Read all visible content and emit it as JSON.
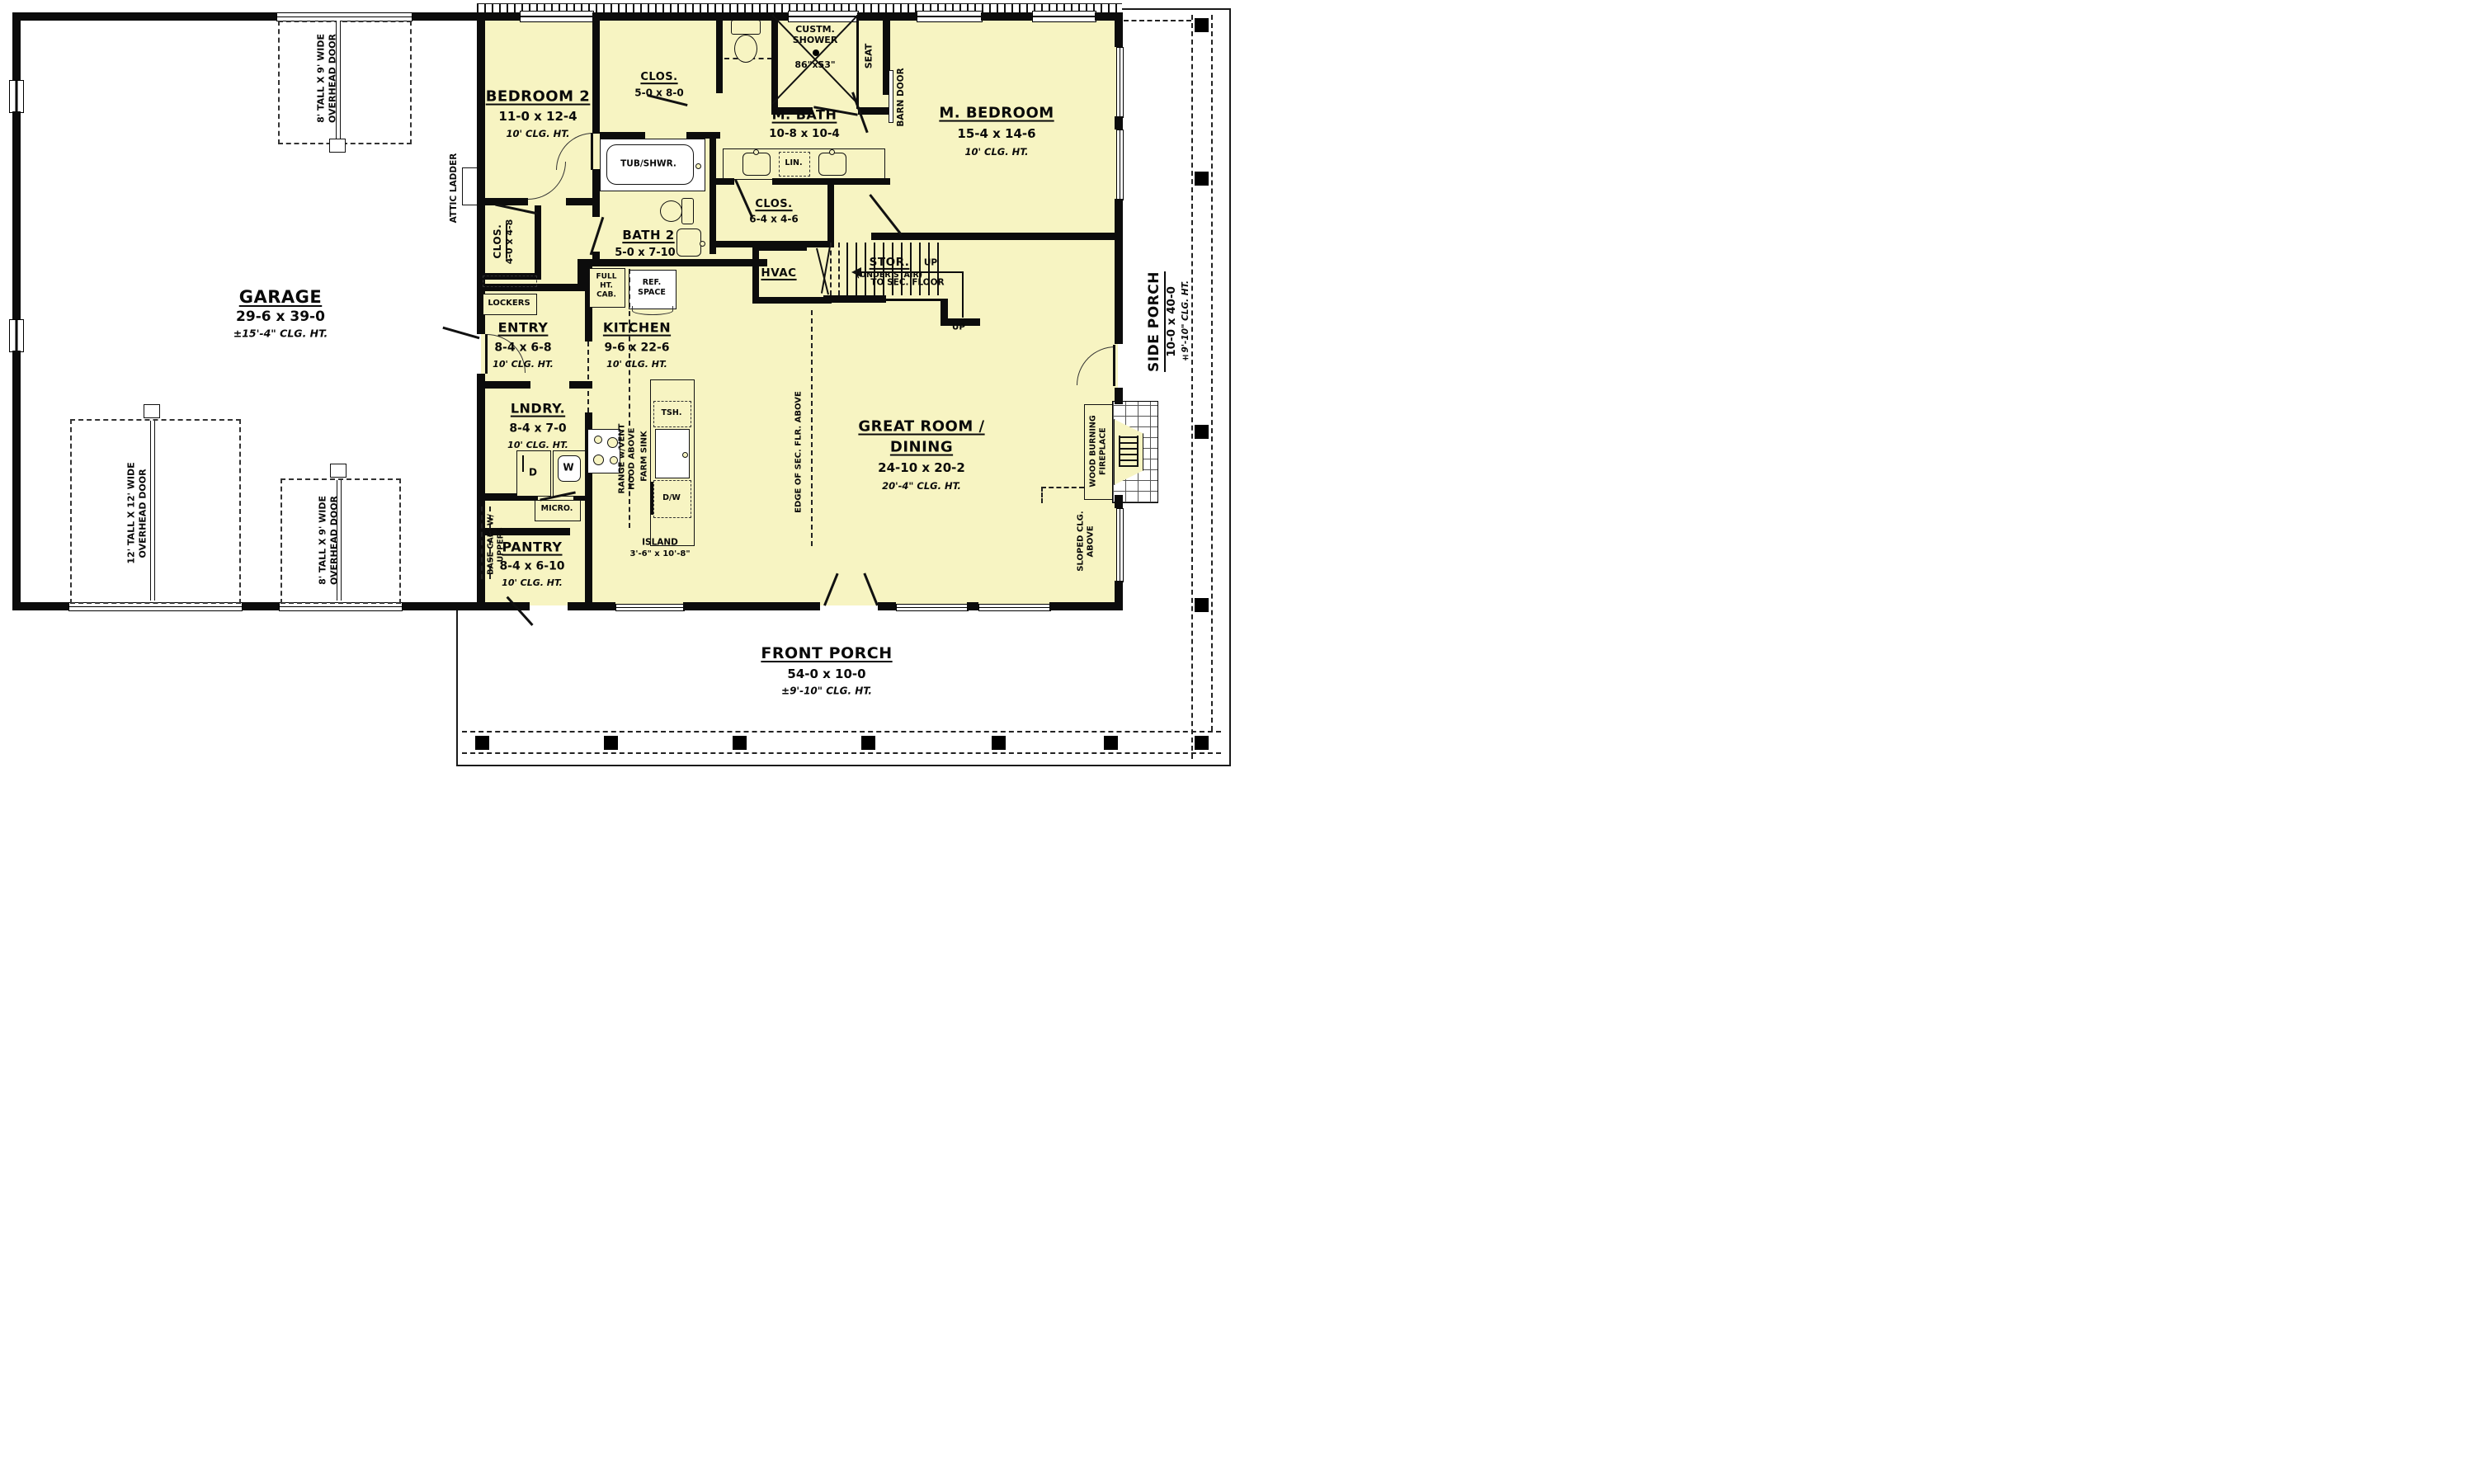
{
  "colors": {
    "room_fill": "#f7f4c2",
    "wall": "#0c0c0c",
    "paper": "#ffffff"
  },
  "rooms": {
    "garage": {
      "name": "GARAGE",
      "dims": "29-6 x 39-0",
      "clg": "±15'-4\" CLG. HT."
    },
    "bedroom2": {
      "name": "BEDROOM 2",
      "dims": "11-0 x 12-4",
      "clg": "10' CLG. HT."
    },
    "clos_hall": {
      "name": "CLOS.",
      "dims": "5-0 x 8-0"
    },
    "custm_shower": {
      "l1": "CUSTM.",
      "l2": "SHOWER",
      "dims": "86\"x53\""
    },
    "m_bath": {
      "name": "M. BATH",
      "dims": "10-8 x 10-4"
    },
    "m_bedroom": {
      "name": "M. BEDROOM",
      "dims": "15-4 x 14-6",
      "clg": "10' CLG. HT."
    },
    "bath2": {
      "name": "BATH 2",
      "dims": "5-0 x 7-10"
    },
    "clos_m": {
      "name": "CLOS.",
      "dims": "6-4 x 4-6"
    },
    "clos_4": {
      "name": "CLOS.",
      "dims": "4-0 x 4-8"
    },
    "stor": {
      "name": "STOR.",
      "sub": "(UNDER STAIR)"
    },
    "hvac": {
      "name": "HVAC"
    },
    "entry": {
      "name": "ENTRY",
      "dims": "8-4 x 6-8",
      "clg": "10' CLG. HT."
    },
    "kitchen": {
      "name": "KITCHEN",
      "dims": "9-6 x 22-6",
      "clg": "10' CLG. HT."
    },
    "lndry": {
      "name": "LNDRY.",
      "dims": "8-4 x 7-0",
      "clg": "10' CLG. HT."
    },
    "pantry": {
      "name": "PANTRY",
      "dims": "8-4 x 6-10",
      "clg": "10' CLG. HT."
    },
    "great_room": {
      "l1": "GREAT ROOM /",
      "l2": "DINING",
      "dims": "24-10 x 20-2",
      "clg": "20'-4\" CLG. HT."
    },
    "front_porch": {
      "name": "FRONT PORCH",
      "dims": "54-0 x 10-0",
      "clg": "±9'-10\" CLG. HT."
    },
    "side_porch": {
      "name": "SIDE PORCH",
      "dims": "10-0 x 40-0",
      "clg": "±9'-10\" CLG. HT."
    }
  },
  "annotations": {
    "door_8x9": {
      "l1": "8' TALL X 9' WIDE",
      "l2": "OVERHEAD DOOR"
    },
    "door_12x12": {
      "l1": "12' TALL X 12' WIDE",
      "l2": "OVERHEAD DOOR"
    },
    "attic_ladder": "ATTIC LADDER",
    "seat": "SEAT",
    "barn_door": "BARN DOOR",
    "tub_shwr": "TUB/SHWR.",
    "lin": "LIN.",
    "lockers": "LOCKERS",
    "full_ht_cab": {
      "l1": "FULL",
      "l2": "HT.",
      "l3": "CAB."
    },
    "ref_space": {
      "l1": "REF.",
      "l2": "SPACE"
    },
    "up": "UP",
    "to_sec_floor": "TO SEC. FLOOR",
    "range": {
      "l1": "RANGE w/VENT",
      "l2": "HOOD ABOVE"
    },
    "tsh": "TSH.",
    "farm_sink": "FARM SINK",
    "dw": "D/W",
    "micro": "MICRO.",
    "island": {
      "name": "ISLAND",
      "dims": "3'-6\" x 10'-8\""
    },
    "base_cab": {
      "l1": "BASE CAB. W/",
      "l2": "UPPERS"
    },
    "edge_sec": "EDGE OF SEC. FLR. ABOVE",
    "fireplace": {
      "l1": "WOOD BURNING",
      "l2": "FIREPLACE"
    },
    "sloped": {
      "l1": "SLOPED CLG.",
      "l2": "ABOVE"
    },
    "dryer": "D",
    "washer": "W"
  }
}
